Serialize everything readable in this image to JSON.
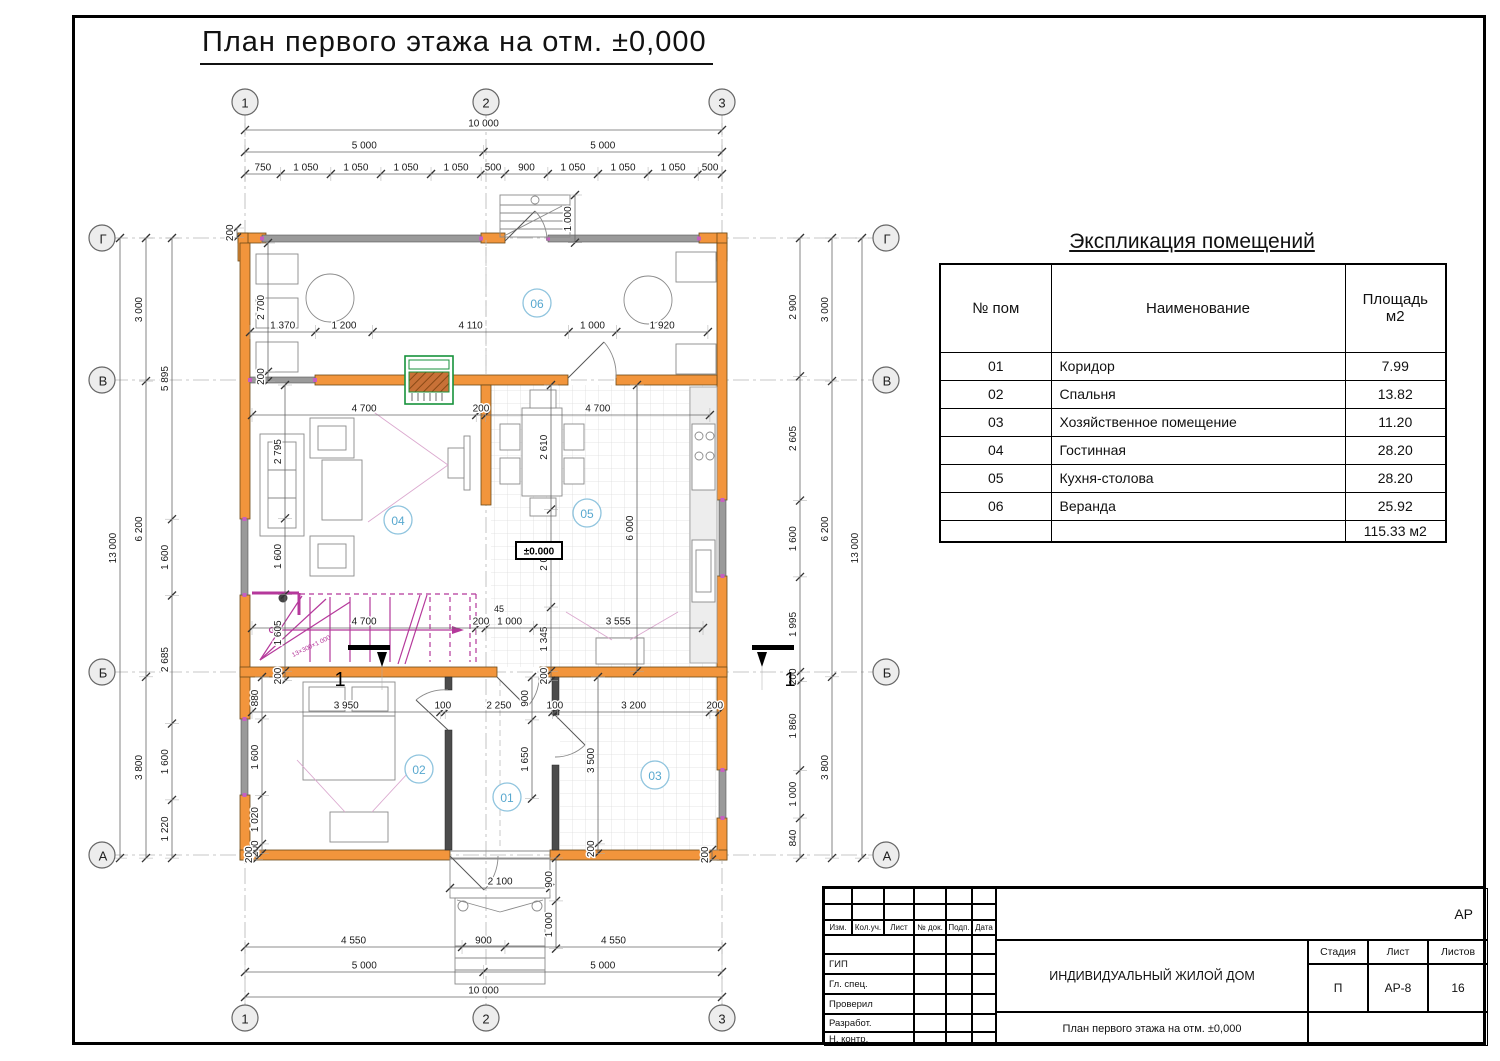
{
  "page_title": "План первого этажа на отм. ±0,000",
  "colors": {
    "wall_orange": "#F2953C",
    "window_gray": "#9a9a9a",
    "partition_dark": "#4c4c4c",
    "stair_magenta": "#b5389b",
    "fireplace_green": "#17923b",
    "fireplace_brown": "#b5651d",
    "room_label_blue": "#58a8cf"
  },
  "axes": {
    "cols": [
      "1",
      "2",
      "3"
    ],
    "rows": [
      "Г",
      "В",
      "Б",
      "А"
    ]
  },
  "dimensions": {
    "t1": [
      "10 000"
    ],
    "t2": [
      "5 000",
      "5 000"
    ],
    "t3": [
      "750",
      "1 050",
      "1 050",
      "1 050",
      "1 050",
      "500",
      "900",
      "1 050",
      "1 050",
      "1 050",
      "500"
    ],
    "st_top": [
      "1 000"
    ],
    "l1": [
      "13 000"
    ],
    "l2": [
      "3 000",
      "6 200",
      "3 800"
    ],
    "l3": [
      "5 895",
      "1 600",
      "2 685",
      "1 600",
      "1 220"
    ],
    "r1": [
      "2 900",
      "2 605",
      "1 600",
      "1 995",
      "200",
      "1 860",
      "1 000",
      "840"
    ],
    "r2": [
      "3 000",
      "6 200",
      "3 800"
    ],
    "r3": [
      "13 000"
    ],
    "b1": [
      "4 550",
      "900",
      "4 550"
    ],
    "b2": [
      "5 000",
      "5 000"
    ],
    "b3": [
      "10 000"
    ],
    "b_door": [
      "2 100"
    ],
    "p_v": [
      "900",
      "1 000"
    ],
    "tl200": [
      "200"
    ],
    "bl200": [
      "200"
    ],
    "br200": [
      "200"
    ],
    "ver_v": [
      "2 700",
      "200"
    ],
    "ver_h": [
      "1 370",
      "1 200",
      "4 110",
      "1 000",
      "1 920"
    ],
    "main_h": [
      "4 700",
      "200",
      "4 700"
    ],
    "liv_vl": [
      "2 795",
      "1 600",
      "1 605",
      "200"
    ],
    "mid_v": [
      "2 610",
      "2 045",
      "1 345",
      "200"
    ],
    "kit_v": [
      "6 000"
    ],
    "stair_h": [
      "4 700",
      "200",
      "1 000",
      "3 555"
    ],
    "bot_h": [
      "3 950",
      "100",
      "2 250",
      "100",
      "3 200",
      "200"
    ],
    "bed_v": [
      "880",
      "1 600",
      "1 020",
      "200"
    ],
    "cor_v": [
      "900",
      "1 650"
    ],
    "r3_v": [
      "3 500",
      "200"
    ]
  },
  "rooms": [
    "06",
    "04",
    "05",
    "02",
    "01",
    "03"
  ],
  "elevation_marker": "±0.000",
  "stair_note": "13×300×1 000",
  "free_labels": {
    "sliver": "45",
    "section_left": "1",
    "section_right": "1"
  },
  "schedule": {
    "title": "Экспликация помещений",
    "headers": [
      "№ пом",
      "Наименование",
      "Площадь м2"
    ],
    "rows": [
      [
        "01",
        "Коридор",
        "7.99"
      ],
      [
        "02",
        "Спальня",
        "13.82"
      ],
      [
        "03",
        "Хозяйственное помещение",
        "11.20"
      ],
      [
        "04",
        "Гостинная",
        "28.20"
      ],
      [
        "05",
        "Кухня-столова",
        "28.20"
      ],
      [
        "06",
        "Веранда",
        "25.92"
      ]
    ],
    "total": "115.33 м2"
  },
  "title_block": {
    "rev_headers": [
      "Изм.",
      "Кол.уч.",
      "Лист",
      "№ док.",
      "Подп.",
      "Дата"
    ],
    "roles": [
      "ГИП",
      "Гл. спец.",
      "Проверил",
      "Разработ.",
      "Н. контр."
    ],
    "project": "ИНДИВИДУАЛЬНЫЙ ЖИЛОЙ ДОМ",
    "sheet_title": "План первого этажа на отм. ±0,000",
    "stage_label": "Стадия",
    "sheet_label": "Лист",
    "sheets_label": "Листов",
    "stage": "П",
    "sheet": "АР-8",
    "sheets": "16",
    "code": "АР"
  }
}
